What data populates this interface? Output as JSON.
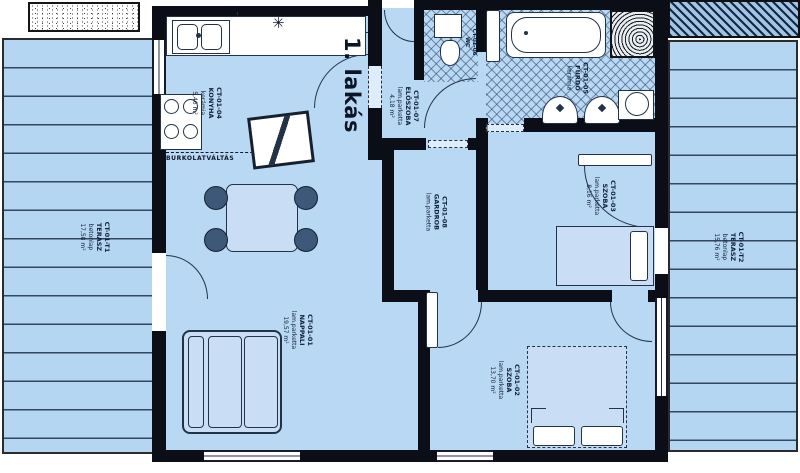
{
  "title": "1. lakás",
  "floor_note": "BURKOLATVÁLTÁS",
  "light_symbol": "✳",
  "rooms": [
    {
      "code": "CT-01-01",
      "name": "NAPPALI",
      "material": "lam.parketta",
      "area": "19,57 m²"
    },
    {
      "code": "CT-01-02",
      "name": "SZOBA",
      "material": "lam.parketta",
      "area": "13,70 m²"
    },
    {
      "code": "CT-01-03",
      "name": "SZOBA",
      "material": "lam.parketta",
      "area": "8,16 m²"
    },
    {
      "code": "CT-01-04",
      "name": "KONYHA",
      "material": "kerámia",
      "area": "5,46 m²"
    },
    {
      "code": "CT-01-05",
      "name": "FÜRDŐ",
      "material": "kerámia",
      "area": ""
    },
    {
      "code": "CT-01-06",
      "name": "WC",
      "material": "",
      "area": ""
    },
    {
      "code": "CT-01-07",
      "name": "ELŐSZOBA",
      "material": "lam.parketta",
      "area": "4,18 m²"
    },
    {
      "code": "CT-01-08",
      "name": "GARDROB",
      "material": "lam.parketta",
      "area": ""
    },
    {
      "code": "CT-01-T1",
      "name": "TERASZ",
      "material": "betonlap",
      "area": "17,58 m²"
    },
    {
      "code": "CT-01-T2",
      "name": "TERASZ",
      "material": "betonlap",
      "area": "15,76 m²"
    }
  ],
  "colors": {
    "floor": "#b9d8f3",
    "wall": "#0b0d17",
    "line": "#223347",
    "terrace_stripe": "#33475e",
    "label_text": "#10203a"
  }
}
